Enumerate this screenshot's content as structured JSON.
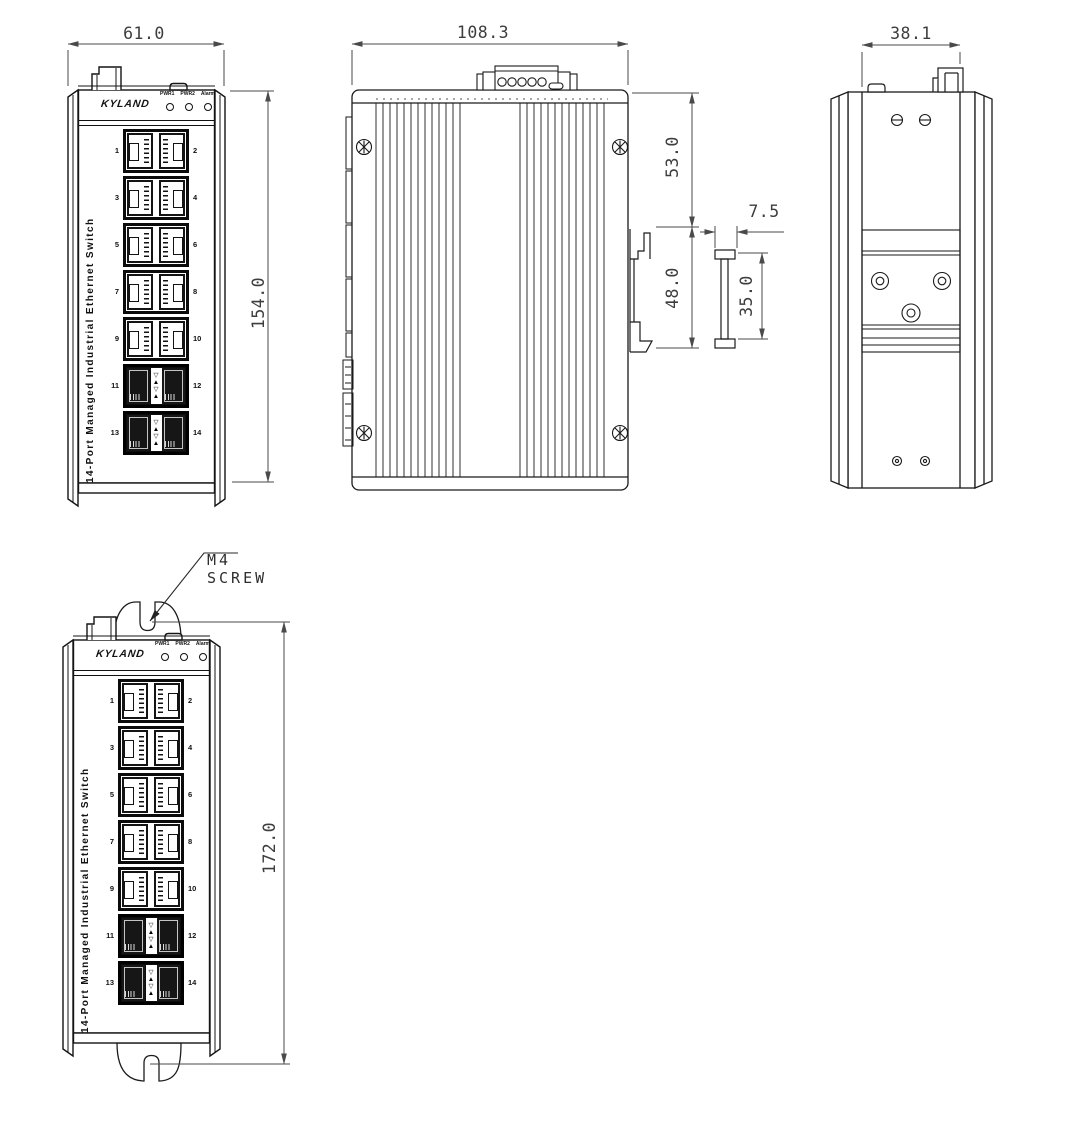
{
  "device": {
    "brand": "KYLAND",
    "led_labels": [
      "PWR1",
      "PWR2",
      "Alarm"
    ],
    "side_text": "14-Port Managed Industrial Ethernet Switch",
    "port_labels": [
      "1",
      "2",
      "3",
      "4",
      "5",
      "6",
      "7",
      "8",
      "9",
      "10",
      "11",
      "12",
      "13",
      "14"
    ],
    "combo_arrows": "▽▲▽▲"
  },
  "dimensions": {
    "front_width_mm": "61.0",
    "front_height_mm": "154.0",
    "side_depth_mm": "108.3",
    "rear_width_mm": "38.1",
    "top_to_rail_mm": "53.0",
    "rail_zone_mm": "48.0",
    "rail_depth_mm": "7.5",
    "rail_height_mm": "35.0",
    "wall_mount_height_mm": "172.0"
  },
  "callout": {
    "line1": "M4",
    "line2": "SCREW"
  },
  "colors": {
    "line": "#1a1a1a",
    "dim_text": "#3d3d3d",
    "background": "#ffffff"
  }
}
